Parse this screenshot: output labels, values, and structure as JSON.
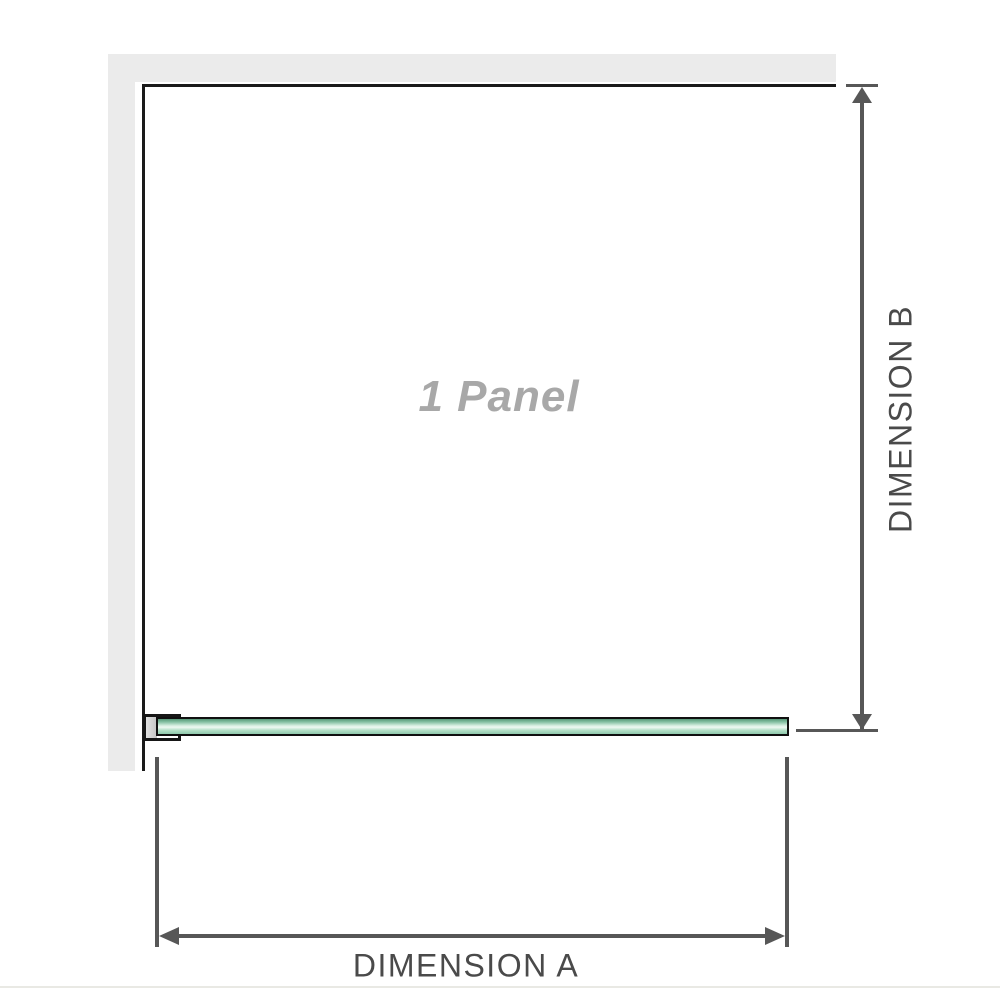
{
  "diagram": {
    "panel_label": "1 Panel",
    "dimensions": {
      "a_label": "DIMENSION A",
      "b_label": "DIMENSION B"
    },
    "icons": {
      "arrow_up": "css-triangle-up",
      "arrow_down": "css-triangle-down",
      "arrow_left": "css-triangle-left",
      "arrow_right": "css-triangle-right"
    },
    "colors": {
      "wall": "#ebebeb",
      "panel_edge": "#1a1a1a",
      "dimension_line": "#575757",
      "label_text": "#4a4a4a",
      "panel_label_text": "#a8a8a8",
      "glass_green_dark": "#589878",
      "glass_green_light": "#eef8f1",
      "clamp_fill": "#c3c3c3",
      "baseline": "#e9e9e4"
    }
  }
}
